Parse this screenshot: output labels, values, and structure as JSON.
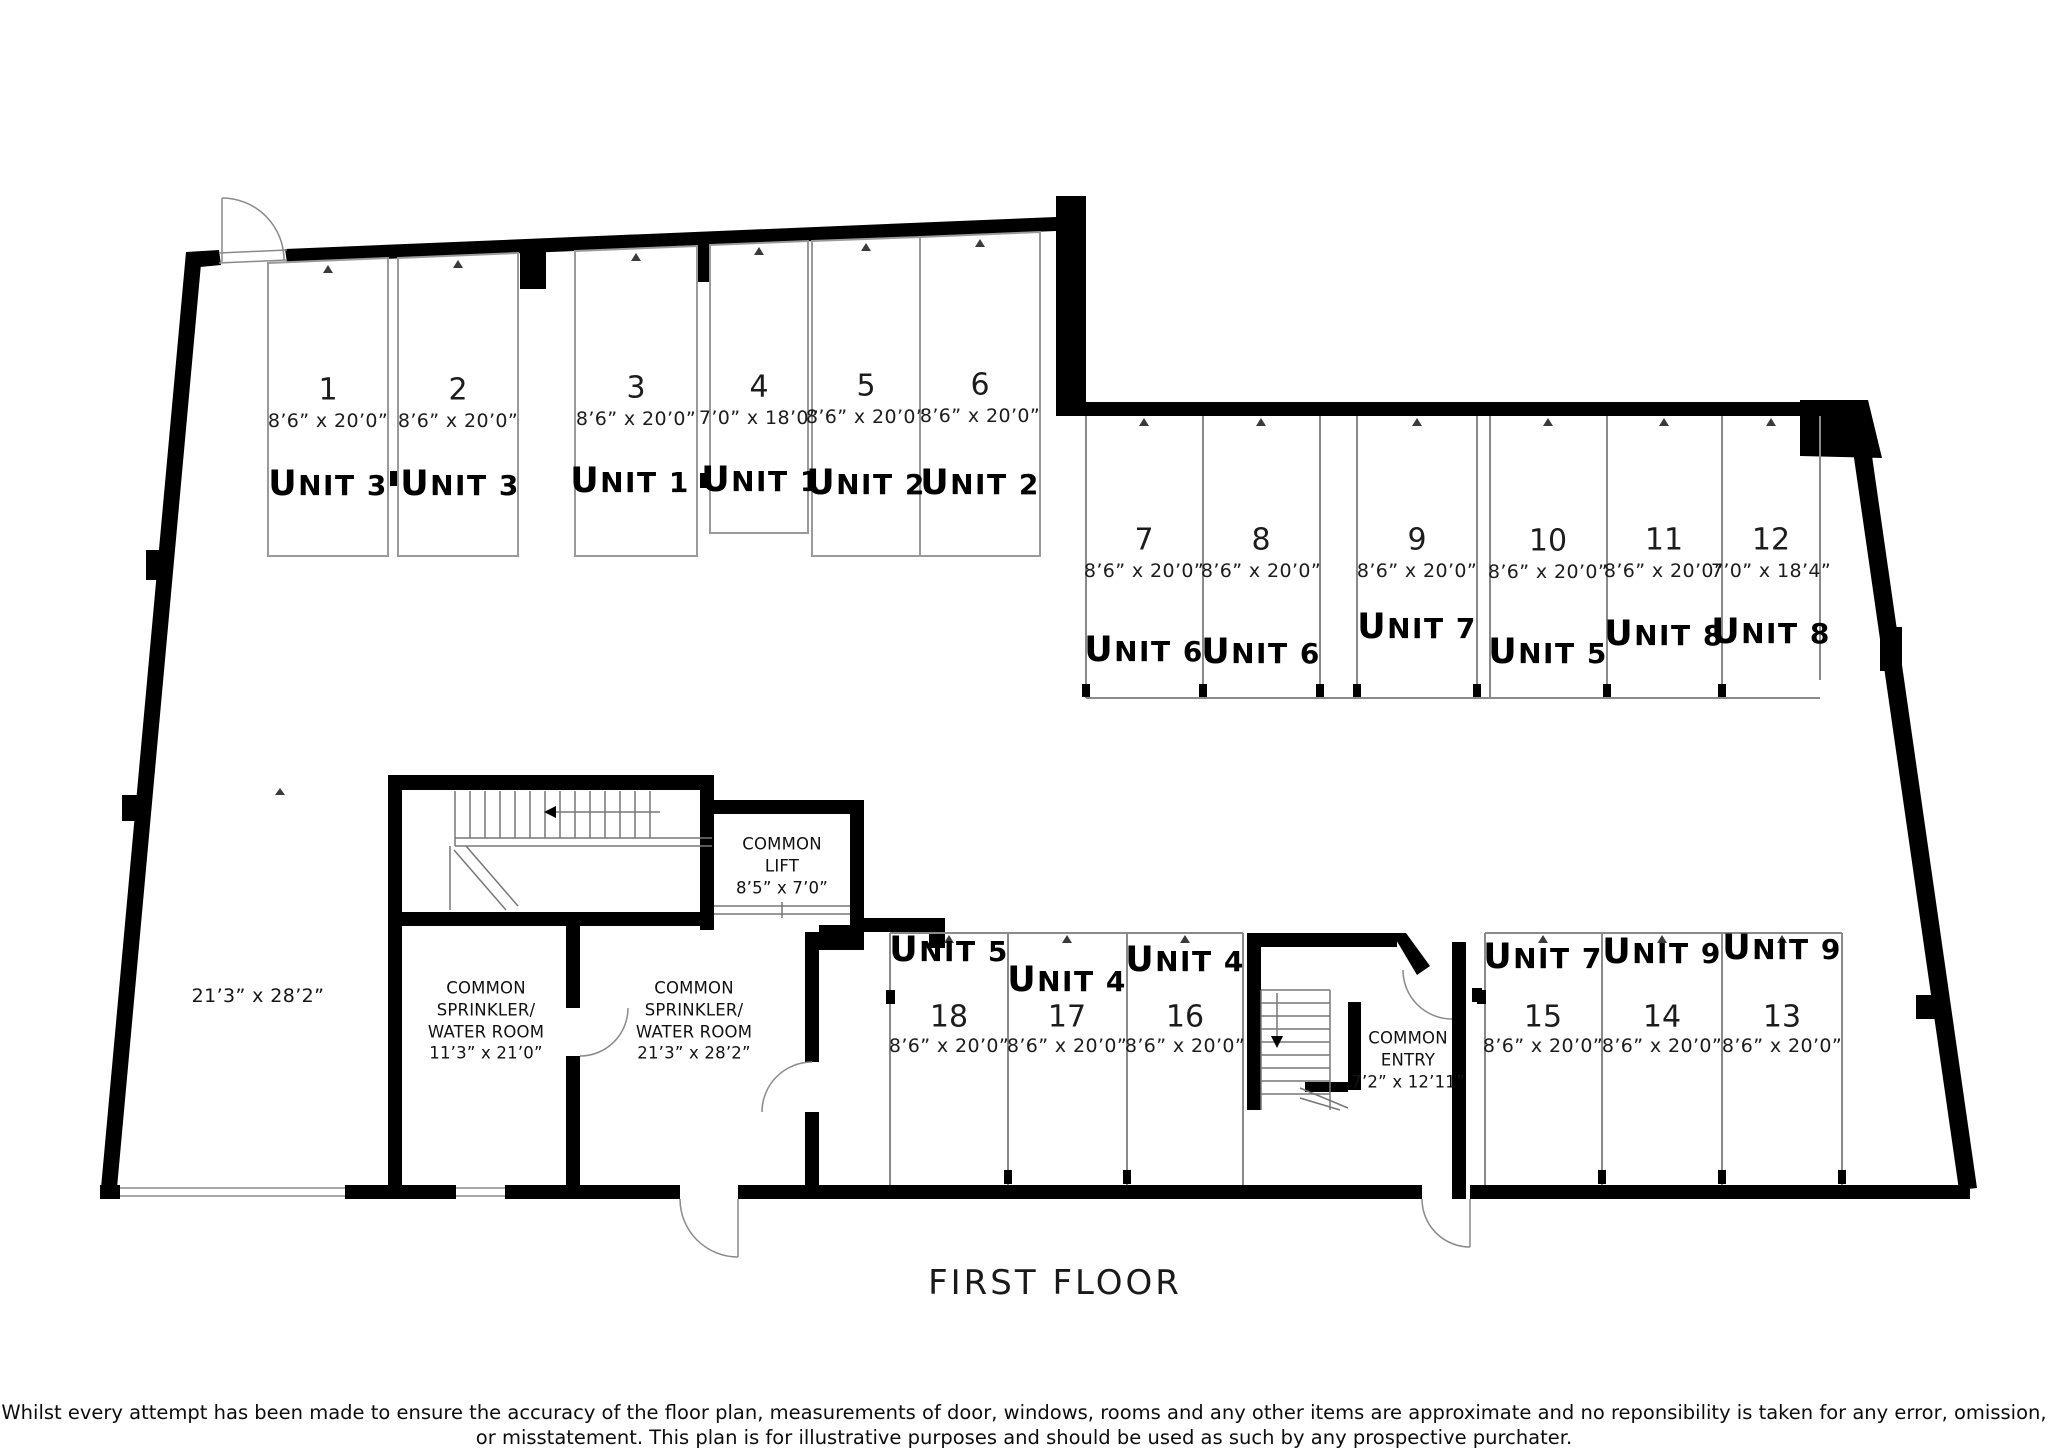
{
  "title": "FIRST FLOOR",
  "disclaimer": "Whilst every attempt has been made to ensure the accuracy of the floor plan, measurements of door, windows, rooms and any other items are approximate and no reponsibility is taken\nfor any error, omission, or misstatement. This plan is for illustrative purposes and should be used as such by any prospective purchater.",
  "open_area": {
    "dims": "21’3” x 28’2”"
  },
  "rooms": {
    "common_lift": "COMMON\nLIFT\n8’5” x 7’0”",
    "sprinkler_small": "COMMON\nSPRINKLER/\nWATER ROOM\n11’3” x 21’0”",
    "sprinkler_large": "COMMON\nSPRINKLER/\nWATER ROOM\n21’3” x 28’2”",
    "common_entry": "COMMON\nENTRY\n7’2” x 12’11”"
  },
  "spaces": [
    {
      "number": "1",
      "dims": "8’6” x 20’0”",
      "unit": "UNIT 3"
    },
    {
      "number": "2",
      "dims": "8’6” x 20’0”",
      "unit": "UNIT 3"
    },
    {
      "number": "3",
      "dims": "8’6” x 20’0”",
      "unit": "UNIT 1"
    },
    {
      "number": "4",
      "dims": "7’0” x 18’0”",
      "unit": "UNIT 1"
    },
    {
      "number": "5",
      "dims": "8’6” x 20’0”",
      "unit": "UNIT 2"
    },
    {
      "number": "6",
      "dims": "8’6” x 20’0”",
      "unit": "UNIT 2"
    },
    {
      "number": "7",
      "dims": "8’6” x 20’0”",
      "unit": "UNIT 6"
    },
    {
      "number": "8",
      "dims": "8’6” x 20’0”",
      "unit": "UNIT 6"
    },
    {
      "number": "9",
      "dims": "8’6” x 20’0”",
      "unit": "UNIT 7"
    },
    {
      "number": "10",
      "dims": "8’6” x 20’0”",
      "unit": "UNIT 5"
    },
    {
      "number": "11",
      "dims": "8’6” x 20’0”",
      "unit": "UNIT 8"
    },
    {
      "number": "12",
      "dims": "7’0” x 18’4”",
      "unit": "UNIT 8"
    },
    {
      "number": "13",
      "dims": "8’6” x 20’0”",
      "unit": "UNIT 9"
    },
    {
      "number": "14",
      "dims": "8’6” x 20’0”",
      "unit": "UNIT 9"
    },
    {
      "number": "15",
      "dims": "8’6” x 20’0”",
      "unit": "UNIT 7"
    },
    {
      "number": "16",
      "dims": "8’6” x 20’0”",
      "unit": "UNIT 4"
    },
    {
      "number": "17",
      "dims": "8’6” x 20’0”",
      "unit": "UNIT 4"
    },
    {
      "number": "18",
      "dims": "8’6” x 20’0”",
      "unit": "UNIT 5"
    }
  ],
  "colors": {
    "wall": "#000000",
    "thin_line": "#8a8a8a",
    "background": "#ffffff"
  }
}
